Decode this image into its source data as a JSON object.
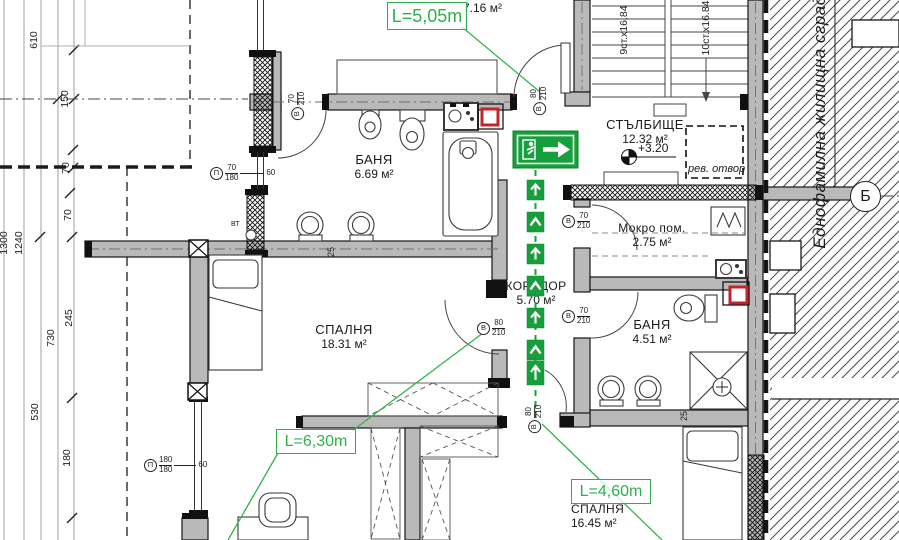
{
  "rooms": {
    "bath_top": {
      "name": "БАНЯ",
      "area": "6.69 м²"
    },
    "bath_right": {
      "name": "БАНЯ",
      "area": "4.51 м²"
    },
    "bedroom_left": {
      "name": "СПАЛНЯ",
      "area": "18.31 м²"
    },
    "bedroom_bottom": {
      "name": "СПАЛНЯ",
      "area": "16.45 м²"
    },
    "corridor": {
      "name": "КОРИДОР",
      "area": "5.70 м²"
    },
    "wet_room": {
      "name": "Мокро пом.",
      "area": "2.75 м²"
    },
    "staircase": {
      "name": "СТЪЛБИЩЕ",
      "area": "12.32 м²",
      "level": "+3.20"
    },
    "adjacent_area": {
      "area": "7.16 м²"
    }
  },
  "escape_route": {
    "length_top": "L=5,05m",
    "length_left": "L=6,30m",
    "length_bottom": "L=4,60m"
  },
  "stairs": {
    "flight_left": "9ст.х16.84",
    "flight_right": "10ст.х16.84"
  },
  "annotations": {
    "revision_opening": "рев. отвор",
    "neighbor_building": "Еднофамилна жилищна сград",
    "downpipe": "ВТ",
    "axis": "Б"
  },
  "openings": {
    "bath_top_door": {
      "letter": "В",
      "width": "70",
      "height": "210"
    },
    "stair_door": {
      "letter": "В",
      "width": "80",
      "height": "210"
    },
    "wet_room_door": {
      "letter": "В",
      "width": "70",
      "height": "210"
    },
    "bath_right_door": {
      "letter": "В",
      "width": "70",
      "height": "210"
    },
    "bedroom_left_door": {
      "letter": "В",
      "width": "80",
      "height": "210"
    },
    "bedroom_bottom_door": {
      "letter": "В",
      "width": "80",
      "height": "210"
    },
    "window_small": {
      "letter": "П",
      "width": "70",
      "height": "180",
      "sill": "60"
    },
    "window_large": {
      "letter": "П",
      "width": "180",
      "height": "180",
      "sill": "60"
    }
  },
  "dimensions": {
    "d610": "610",
    "d150": "150",
    "d70_top": "70",
    "d1300": "1300",
    "d1240": "1240",
    "d70_mid": "70",
    "d245": "245",
    "d730": "730",
    "d530": "530",
    "d180": "180",
    "wall25_left": "25",
    "wall25_right": "25"
  },
  "colors": {
    "escape_green": "#169f3c",
    "wall_gray": "#b9b9b9",
    "shaft_red": "#c4232a"
  }
}
